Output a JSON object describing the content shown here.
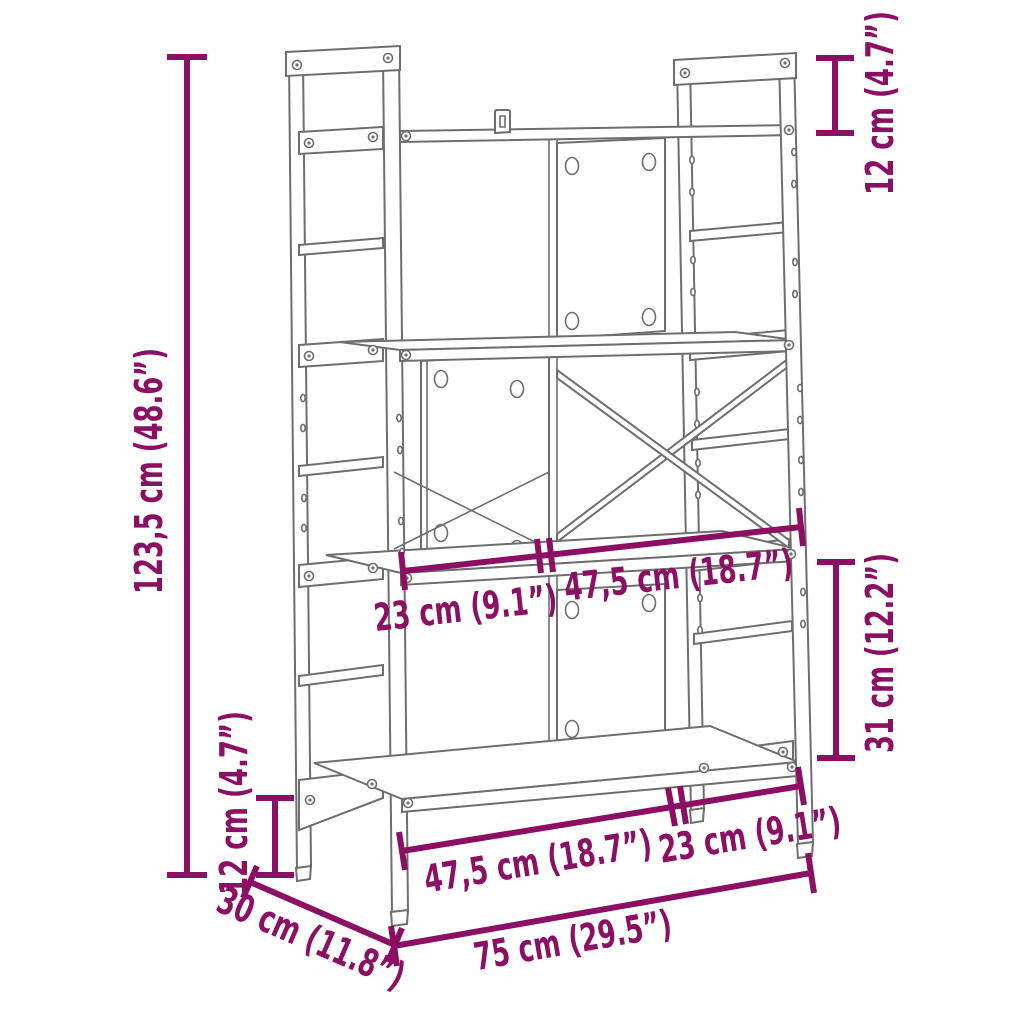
{
  "diagram": {
    "kind": "product-dimension-diagram",
    "object": "four-tier shelving unit line drawing",
    "colors": {
      "accent": "#8B0F63",
      "line": "#6E6E6E",
      "background": "#FFFFFF"
    },
    "annotations": {
      "total_height": {
        "label": "123,5 cm (48.6”)",
        "orientation": "vertical-left"
      },
      "leg_height": {
        "label": "12 cm (4.7”)",
        "orientation": "vertical-bottom-left"
      },
      "top_frame_extension": {
        "label": "12 cm (4.7”)",
        "orientation": "vertical-top-right"
      },
      "tier_height": {
        "label": "31 cm (12.2”)",
        "orientation": "vertical-right"
      },
      "middle_depth_span": {
        "label": "23 cm (9.1”)",
        "orientation": "along-middle-shelf"
      },
      "middle_width_span": {
        "label": "47,5 cm (18.7”)",
        "orientation": "along-middle-shelf"
      },
      "bottom_width_span": {
        "label": "47,5 cm (18.7”)",
        "orientation": "along-bottom-shelf"
      },
      "bottom_depth_span": {
        "label": "23 cm (9.1”)",
        "orientation": "along-bottom-shelf"
      },
      "total_width": {
        "label": "75 cm (29.5”)",
        "orientation": "along-floor-front"
      },
      "total_depth": {
        "label": "30 cm (11.8”)",
        "orientation": "along-floor-side"
      }
    }
  }
}
